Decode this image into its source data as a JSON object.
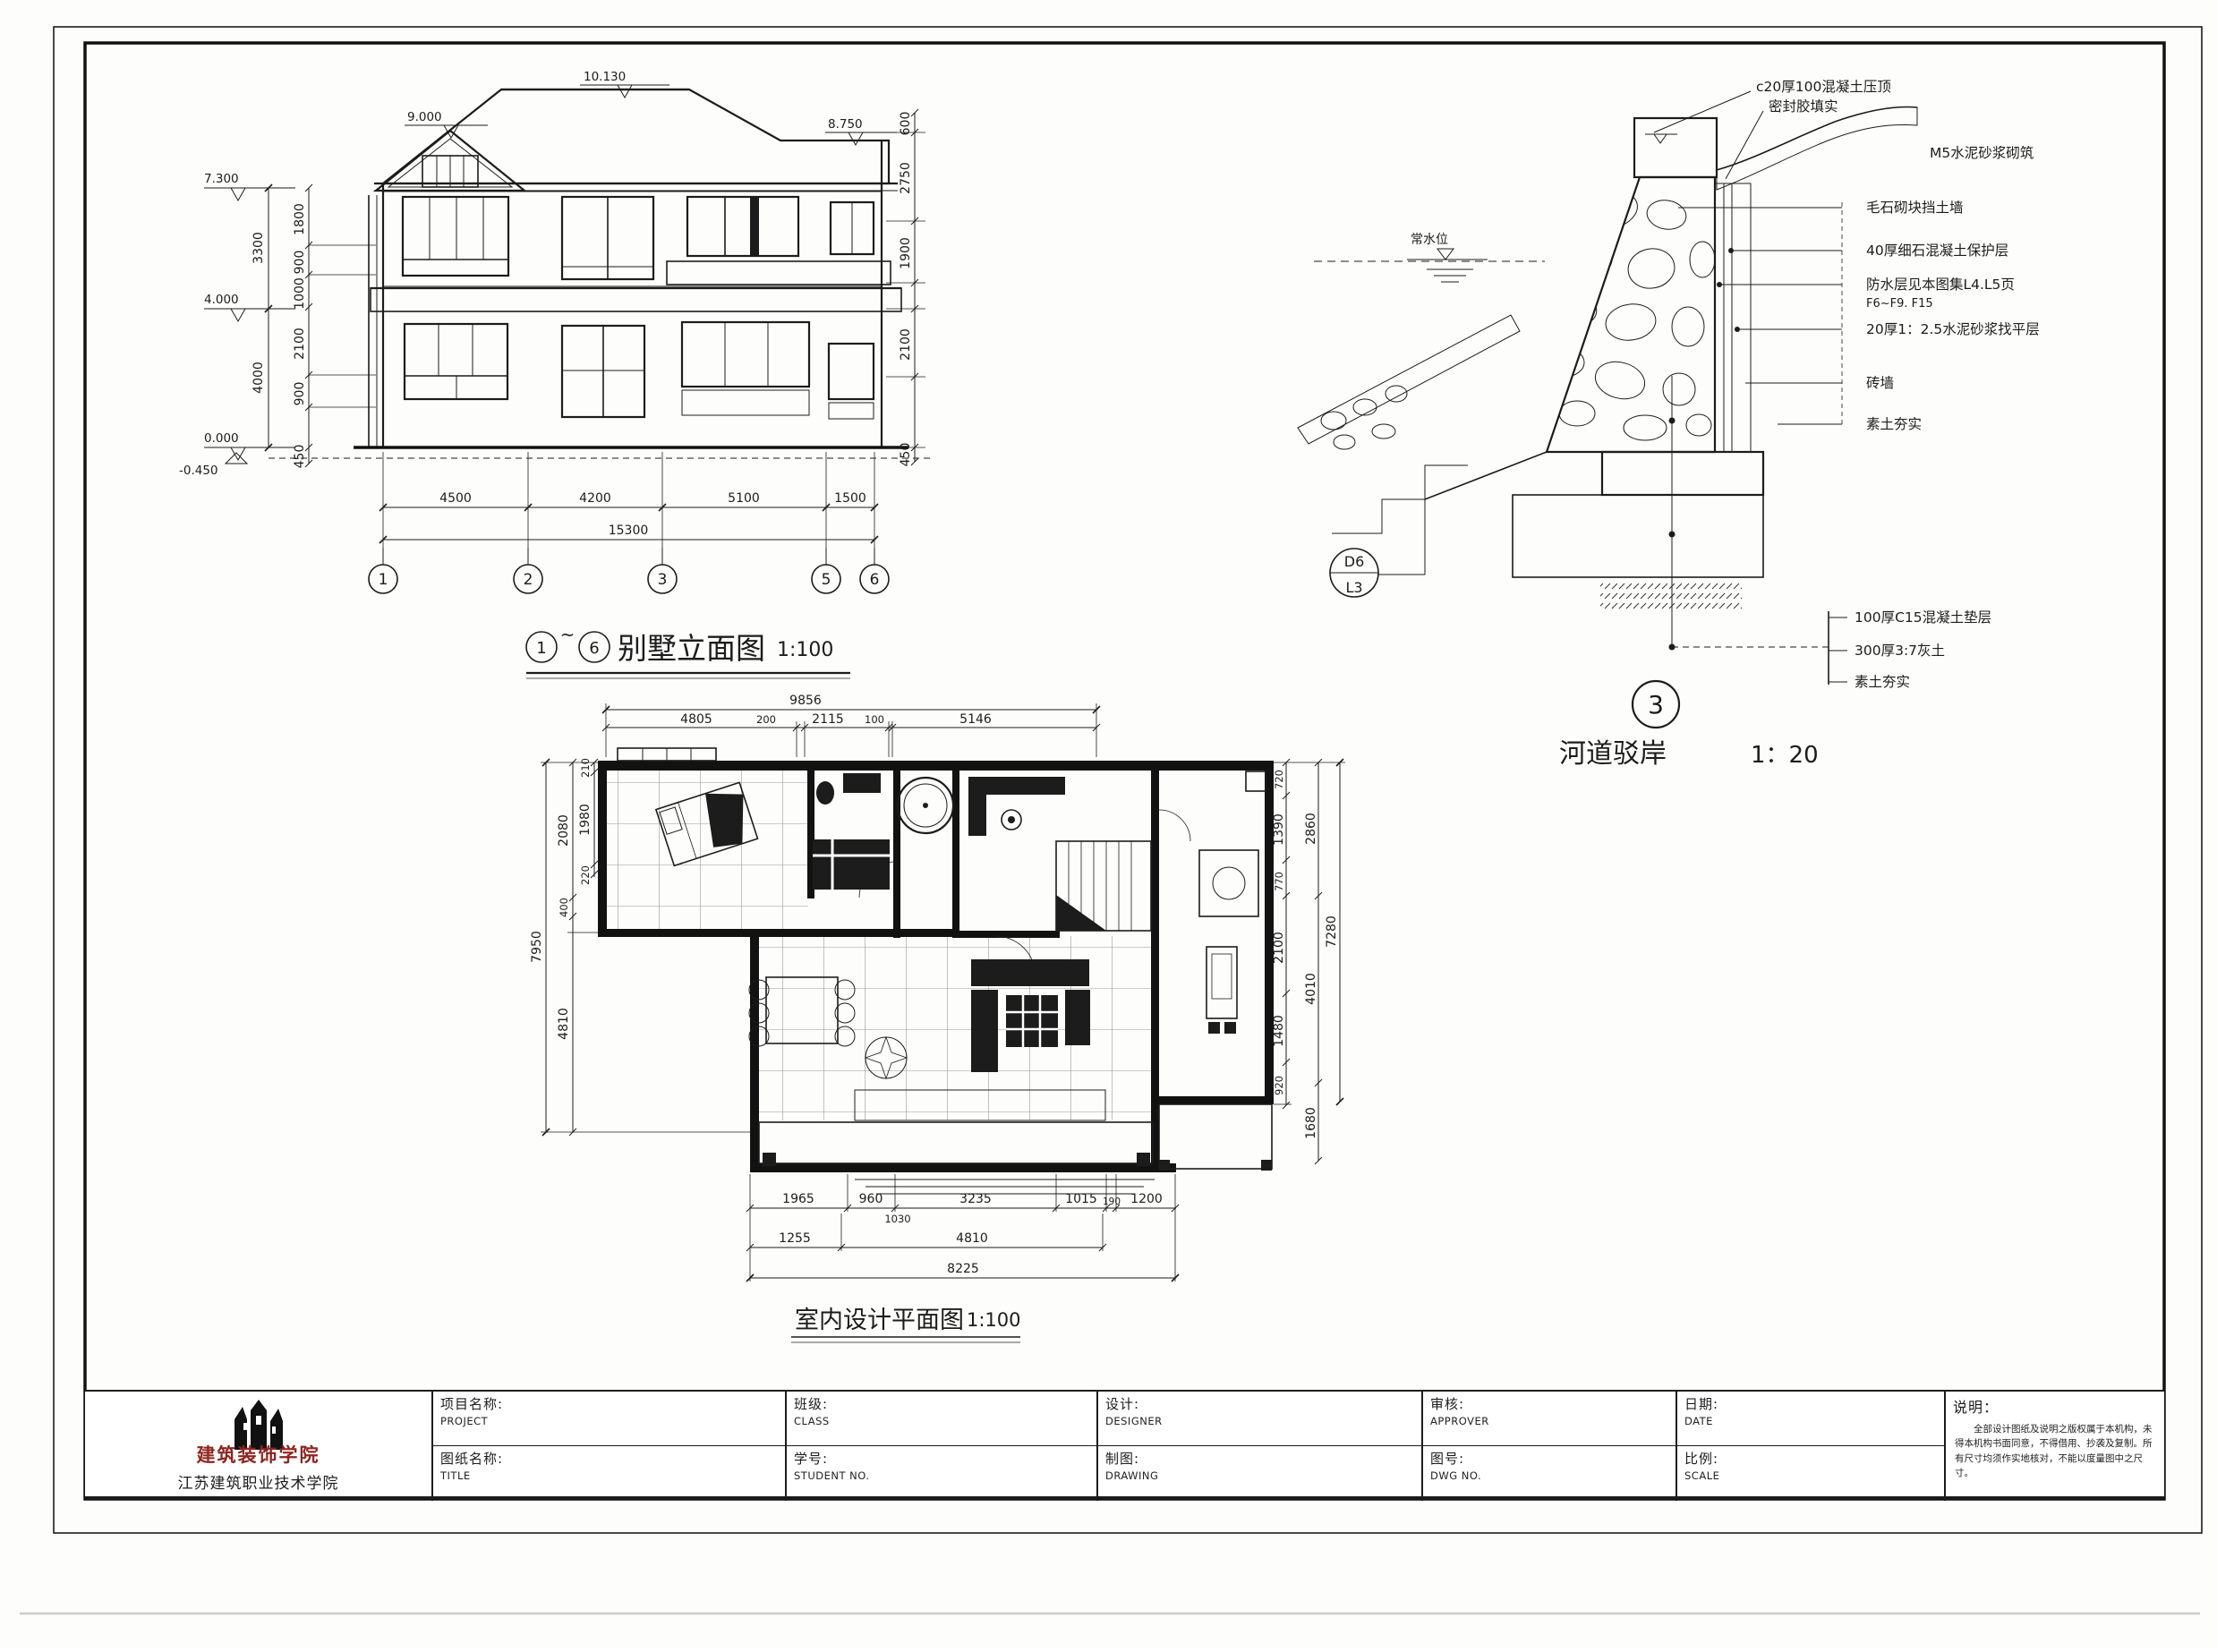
{
  "colors": {
    "ink": "#1c1c1c",
    "logo_red": "#8f241f"
  },
  "elevation": {
    "name": "别墅立面图",
    "scale": "1:100",
    "range_start": "1",
    "range_separator": "~",
    "range_end": "6",
    "levels": {
      "ridge": "10.130",
      "left_gable": "9.000",
      "right_roof": "8.750",
      "eave": "7.300",
      "floor2": "4.000",
      "ground": "0.000",
      "below_ground": "-0.450"
    },
    "dims_left_outer": [
      "3300",
      "4000"
    ],
    "dims_left_inner": [
      "1800",
      "900",
      "1000",
      "2100",
      "900",
      "450"
    ],
    "dims_right": [
      "600",
      "2750",
      "1900",
      "2100",
      "450"
    ],
    "dims_bottom": [
      "4500",
      "4200",
      "5100",
      "1500"
    ],
    "dim_bottom_total": "15300",
    "grid_bubbles": [
      "1",
      "2",
      "3",
      "5",
      "6"
    ]
  },
  "revetment": {
    "bubble_number": "3",
    "name": "河道驳岸",
    "scale": "1：20",
    "ref_top": "D6",
    "ref_bottom": "L3",
    "water_level": "常水位",
    "ann_top": [
      "c20厚100混凝土压顶",
      "密封胶填实",
      "M5水泥砂浆砌筑"
    ],
    "ann_right": [
      "毛石砌块挡土墙",
      "40厚细石混凝土保护层",
      "防水层见本图集L4.L5页",
      "F6~F9. F15",
      "20厚1：2.5水泥砂浆找平层",
      "砖墙",
      "素土夯实"
    ],
    "ann_bottom": [
      "100厚C15混凝土垫层",
      "300厚3:7灰土",
      "素土夯实"
    ]
  },
  "floorplan": {
    "name": "室内设计平面图",
    "scale": "1:100",
    "dims_top_total": "9856",
    "dims_top": [
      "4805",
      "200",
      "2115",
      "100",
      "5146"
    ],
    "dims_left_total": "7950",
    "dims_left_outer": [
      "2080",
      "400",
      "4810"
    ],
    "dims_left_inner": [
      "210",
      "1980",
      "220"
    ],
    "dims_right_total": "7280",
    "dims_right_mid": [
      "2860",
      "4010",
      "1680"
    ],
    "dims_right_inner": [
      "720",
      "1390",
      "770",
      "2100",
      "1480",
      "920"
    ],
    "dims_bottom_row1": [
      "1965",
      "960",
      "1030",
      "3235",
      "1015",
      "190",
      "1200"
    ],
    "dims_bottom_row2": [
      "1255",
      "4810"
    ],
    "dims_bottom_total": "8225"
  },
  "titleblock": {
    "fields": [
      {
        "zh": "项目名称:",
        "en": "PROJECT"
      },
      {
        "zh": "班级:",
        "en": "CLASS"
      },
      {
        "zh": "设计:",
        "en": "DESIGNER"
      },
      {
        "zh": "审核:",
        "en": "APPROVER"
      },
      {
        "zh": "日期:",
        "en": "DATE"
      },
      {
        "zh": "图纸名称:",
        "en": "TITLE"
      },
      {
        "zh": "学号:",
        "en": "STUDENT NO."
      },
      {
        "zh": "制图:",
        "en": "DRAWING"
      },
      {
        "zh": "图号:",
        "en": "DWG NO."
      },
      {
        "zh": "比例:",
        "en": "SCALE"
      }
    ]
  },
  "logo": {
    "line1": "建筑装饰学院",
    "line2": "江苏建筑职业技术学院"
  },
  "notes": {
    "label": "说明：",
    "text": "全部设计图纸及说明之版权属于本机构，未得本机构书面同意，不得借用、抄袭及复制。所有尺寸均须作实地核对，不能以度量图中之尺寸。"
  }
}
